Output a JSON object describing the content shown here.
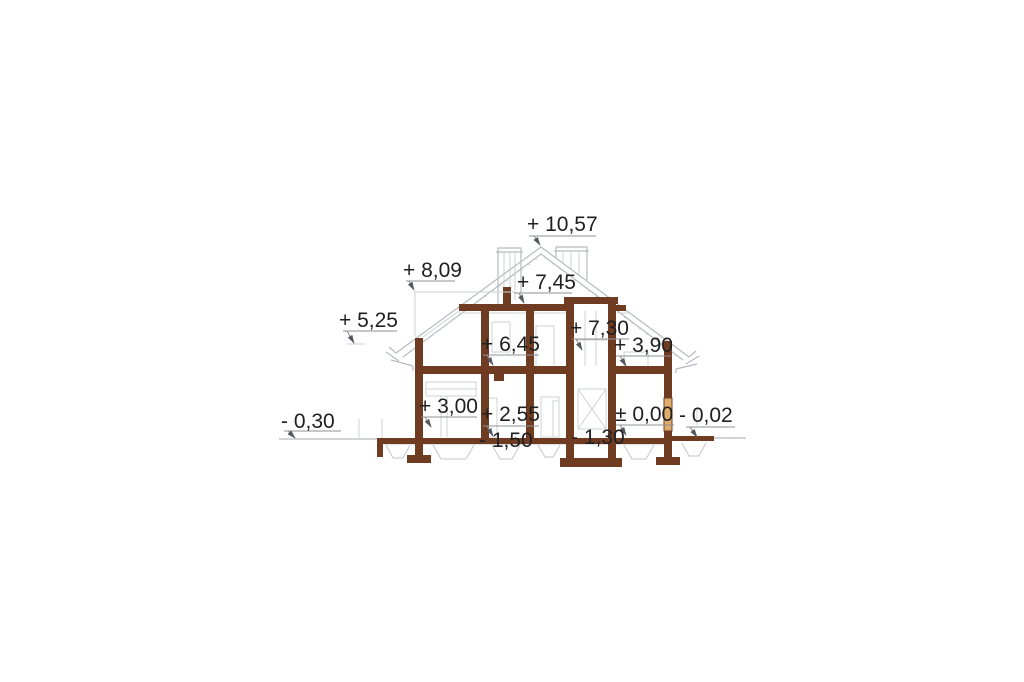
{
  "drawing": {
    "colors": {
      "wall_brown": "#6f3c22",
      "window_wood_tan": "#e0ac6c",
      "line_gray": "#b7bac0",
      "light_gray": "#cdd0d5",
      "text_dark": "#202020",
      "background": "#ffffff"
    },
    "level_labels": [
      {
        "id": "ridge",
        "text": "+ 10,57"
      },
      {
        "id": "roof-left",
        "text": "+ 8,09"
      },
      {
        "id": "attic-collar",
        "text": "+ 7,45"
      },
      {
        "id": "chimney-cap",
        "text": "+ 7,30"
      },
      {
        "id": "eave-left",
        "text": "+ 5,25"
      },
      {
        "id": "attic-interior",
        "text": "+ 6,45"
      },
      {
        "id": "attic-right",
        "text": "+ 3,90"
      },
      {
        "id": "storey-left",
        "text": "+ 3,00"
      },
      {
        "id": "storey-mid",
        "text": "+ 2,55"
      },
      {
        "id": "ground-zero",
        "text": "± 0,00"
      },
      {
        "id": "terrace-right",
        "text": "- 0,02"
      },
      {
        "id": "grade-left",
        "text": "- 0,30"
      },
      {
        "id": "foundation-mid",
        "text": "- 1,50"
      },
      {
        "id": "foundation-chimney",
        "text": "- 1,30"
      }
    ]
  }
}
